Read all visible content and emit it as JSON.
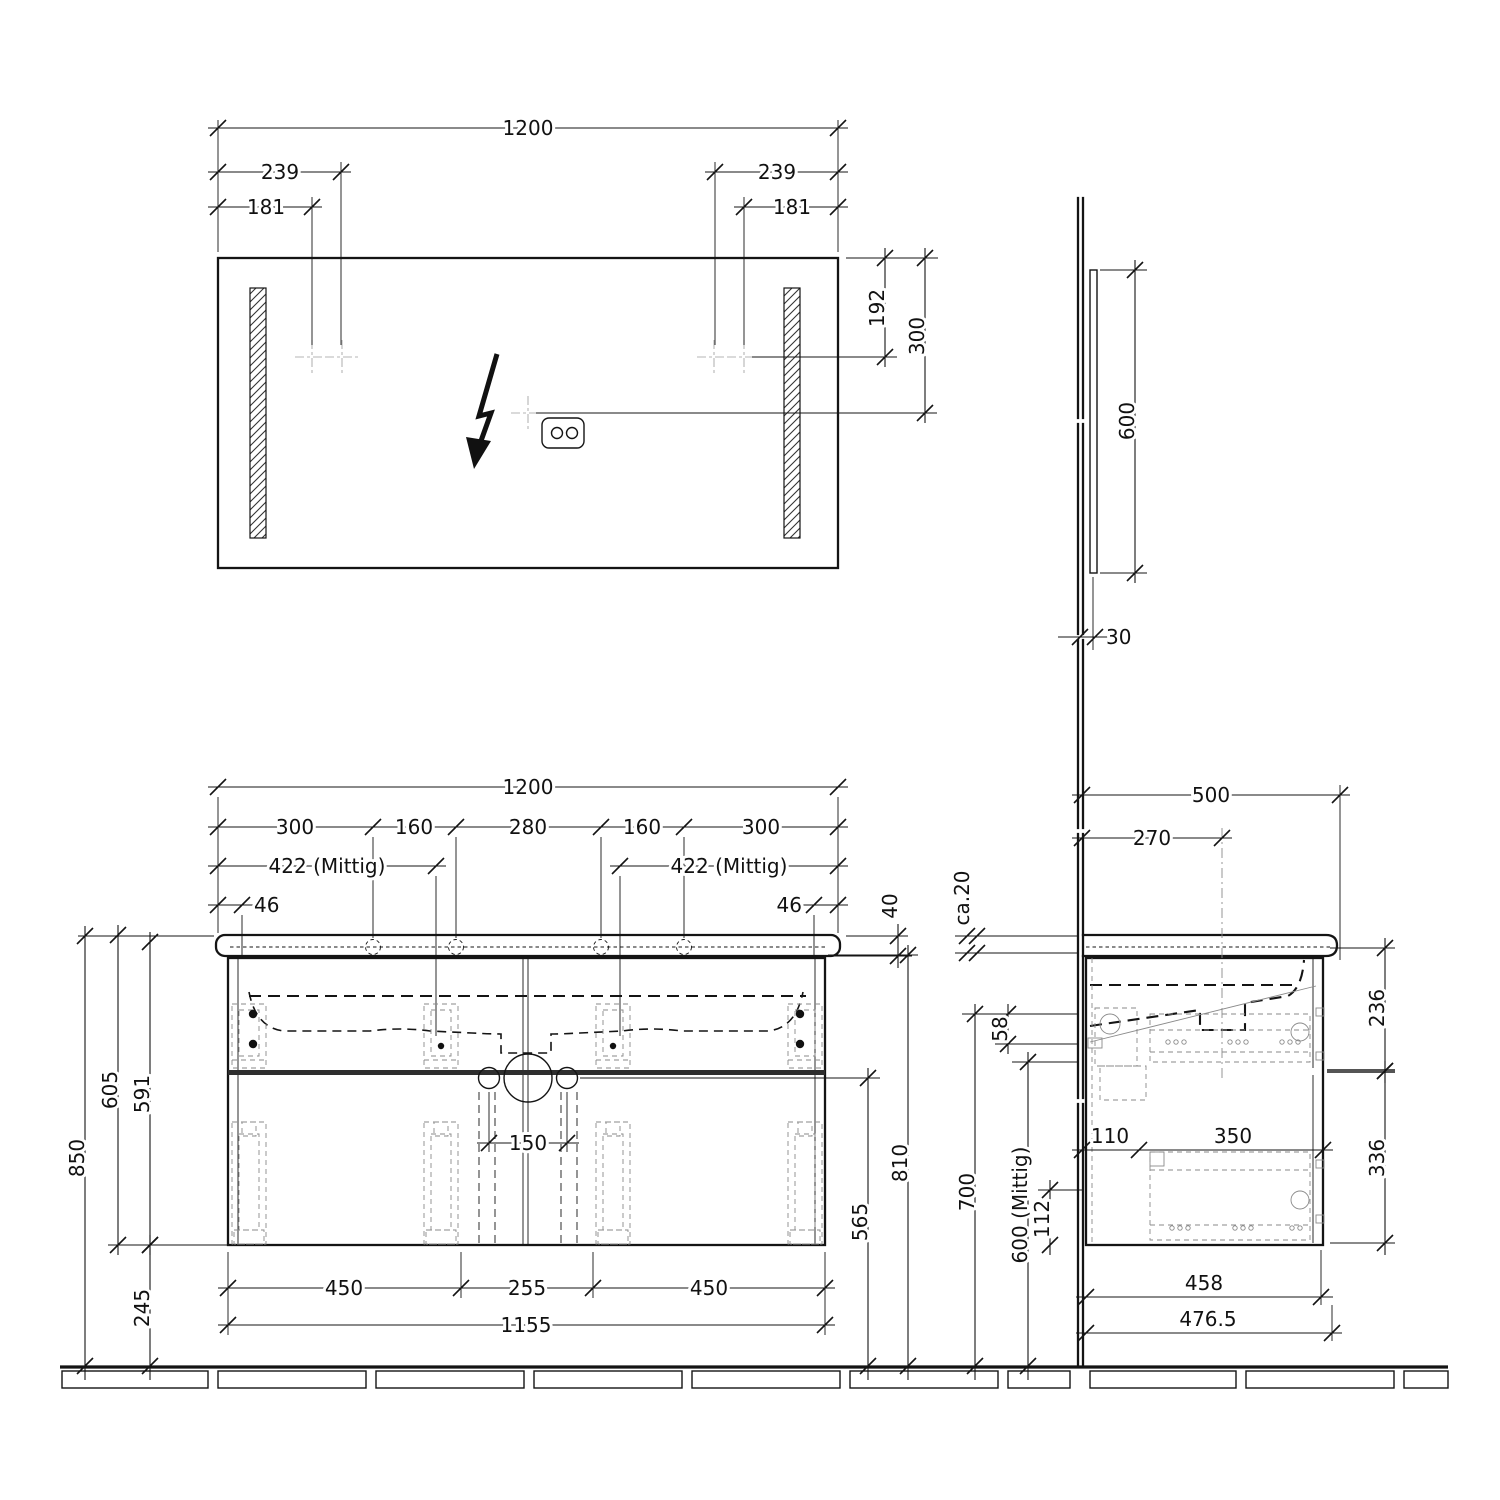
{
  "drawing": {
    "mirror_front": {
      "width": "1200",
      "left_239": "239",
      "left_181": "181",
      "right_239": "239",
      "right_181": "181",
      "v192": "192",
      "v300": "300"
    },
    "mirror_side": {
      "height": "600",
      "depth": "30"
    },
    "vanity_front": {
      "width": "1200",
      "seg300l": "300",
      "seg160l": "160",
      "seg280": "280",
      "seg160r": "160",
      "seg300r": "300",
      "mittig_left": "422 (Mittig)",
      "mittig_right": "422 (Mittig)",
      "d46l": "46",
      "d46r": "46",
      "top_thickness": "40",
      "h850": "850",
      "h605": "605",
      "h591": "591",
      "h245": "245",
      "drain_gap": "150",
      "b450l": "450",
      "b255": "255",
      "b450r": "450",
      "b1155": "1155",
      "h565": "565",
      "h810": "810"
    },
    "vanity_side": {
      "depth": "500",
      "d270": "270",
      "ca20": "ca.20",
      "d58": "58",
      "d236": "236",
      "d336": "336",
      "d110": "110",
      "d350": "350",
      "d112": "112",
      "h700": "700",
      "h600m": "600 (Mittig)",
      "d458": "458",
      "d476": "476.5"
    }
  }
}
